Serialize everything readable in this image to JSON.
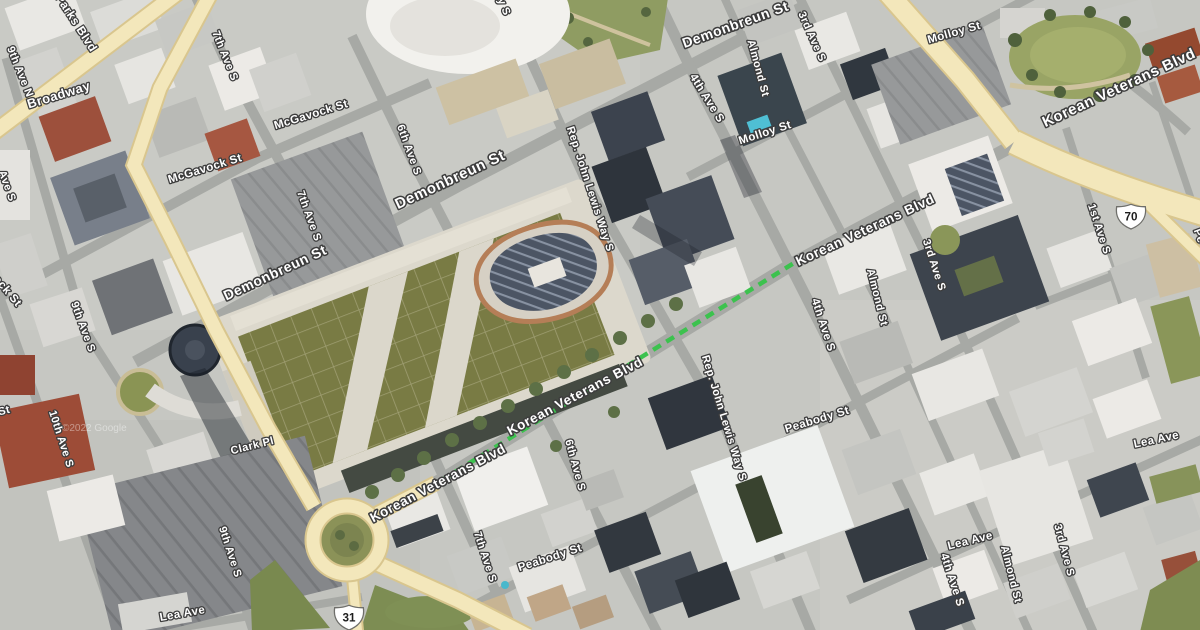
{
  "map": {
    "view_type": "satellite-imagery",
    "attribution_watermark": "©2022 Google",
    "highlighted_route": {
      "style": "dashed-line",
      "color": "#3cc24e",
      "along_street": "Korean Veterans Blvd"
    },
    "route_shields": [
      {
        "system": "US",
        "number": "70"
      },
      {
        "system": "US",
        "number": "31"
      }
    ],
    "street_labels": [
      {
        "text": "9th Ave N"
      },
      {
        "text": "Parks Blvd"
      },
      {
        "text": "Broadway"
      },
      {
        "text": "7th Ave S"
      },
      {
        "text": "McGavock St"
      },
      {
        "text": "McGavock St"
      },
      {
        "text": "McGavock St"
      },
      {
        "text": "Demonbreun St"
      },
      {
        "text": "Demonbreun St"
      },
      {
        "text": "Demonbreun St"
      },
      {
        "text": "6th Ave S"
      },
      {
        "text": "7th Ave S"
      },
      {
        "text": "Rep. John Lewis Way S"
      },
      {
        "text": "Rep. John Lewis Way S"
      },
      {
        "text": "Molloy St"
      },
      {
        "text": "Molloy St"
      },
      {
        "text": "Almond St"
      },
      {
        "text": "Almond St"
      },
      {
        "text": "Almond St"
      },
      {
        "text": "3rd Ave S"
      },
      {
        "text": "3rd Ave S"
      },
      {
        "text": "3rd Ave S"
      },
      {
        "text": "4th Ave S"
      },
      {
        "text": "4th Ave S"
      },
      {
        "text": "4th Ave S"
      },
      {
        "text": "Korean Veterans Blvd"
      },
      {
        "text": "Korean Veterans Blvd"
      },
      {
        "text": "Korean Veterans Blvd"
      },
      {
        "text": "Korean Veterans Blvd"
      },
      {
        "text": "6th Ave S"
      },
      {
        "text": "7th Ave S"
      },
      {
        "text": "Peabody St"
      },
      {
        "text": "Peabody St"
      },
      {
        "text": "Clark Pl"
      },
      {
        "text": "10th Ave S"
      },
      {
        "text": "9th Ave S"
      },
      {
        "text": "9th Ave S"
      },
      {
        "text": "Lea Ave"
      },
      {
        "text": "Lea Ave"
      },
      {
        "text": "Lea Ave"
      },
      {
        "text": "1st Ave S"
      },
      {
        "text": "Ave S"
      },
      {
        "text": "St"
      },
      {
        "text": "y S"
      },
      {
        "text": "Pe"
      }
    ]
  }
}
